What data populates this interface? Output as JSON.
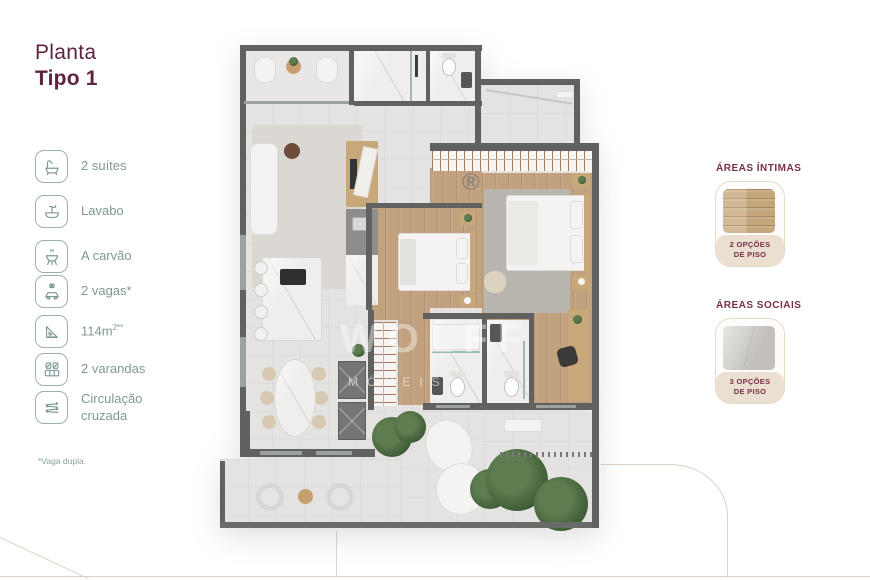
{
  "title": {
    "line1": "Planta",
    "line2": "Tipo 1"
  },
  "legend": {
    "items": [
      {
        "icon": "bathtub-icon",
        "label": "2 suítes"
      },
      {
        "icon": "sink-icon",
        "label": "Lavabo"
      },
      {
        "icon": "grill-icon",
        "label": "A carvão"
      },
      {
        "icon": "car-icon",
        "label": "2 vagas*"
      },
      {
        "icon": "ruler-icon",
        "label": "114m",
        "sup": "2**"
      },
      {
        "icon": "balcony-icon",
        "label": "2 varandas"
      },
      {
        "icon": "arrows-icon",
        "label": "Circulação cruzada"
      }
    ],
    "footnote": "*Vaga dupla."
  },
  "flooring": {
    "sections": [
      {
        "heading": "ÁREAS ÍNTIMAS",
        "caption_line1": "2 OPÇÕES",
        "caption_line2": "DE PISO",
        "swatch": "wood-floor-swatch"
      },
      {
        "heading": "ÁREAS SOCIAIS",
        "caption_line1": "3 OPÇÕES",
        "caption_line2": "DE PISO",
        "swatch": "stone-floor-swatch"
      }
    ]
  },
  "plan": {
    "watermark_brand": "WOLFF",
    "watermark_sub": "MÓVEIS",
    "watermark_reg": "®",
    "registered_mark": "®"
  },
  "colors": {
    "accent_maroon": "#5d2342",
    "heading_maroon": "#7a2f48",
    "legend_teal": "#7e9b97",
    "card_beige": "#eadfd0",
    "wall_gray": "#616160",
    "wood_floor": "#c1a17e"
  }
}
